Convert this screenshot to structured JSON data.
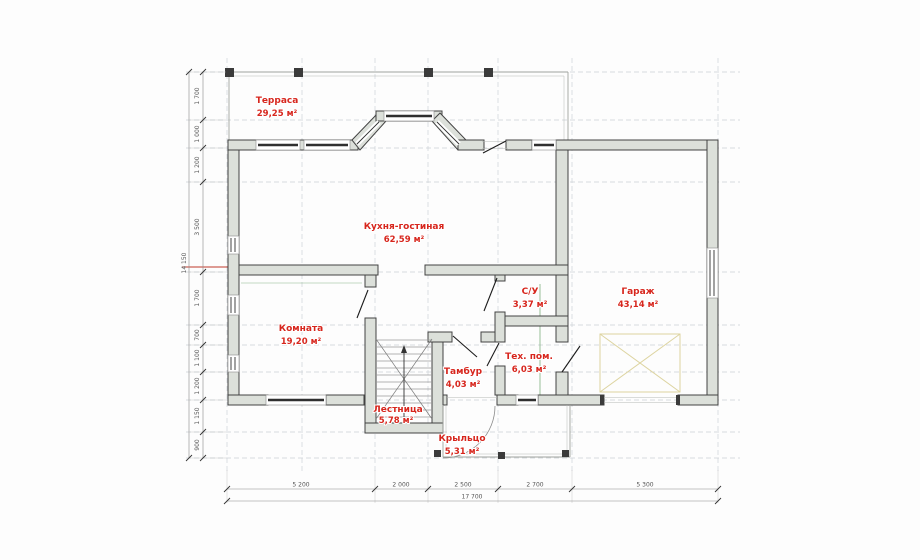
{
  "plan_type": "floor-plan",
  "rooms": [
    {
      "name": "Терраса",
      "area": "29,25 м²"
    },
    {
      "name": "Кухня-гостиная",
      "area": "62,59 м²"
    },
    {
      "name": "Комната",
      "area": "19,20 м²"
    },
    {
      "name": "С/У",
      "area": "3,37 м²"
    },
    {
      "name": "Гараж",
      "area": "43,14 м²"
    },
    {
      "name": "Тамбур",
      "area": "4,03 м²"
    },
    {
      "name": "Тех. пом.",
      "area": "6,03 м²"
    },
    {
      "name": "Лестница",
      "area": "5,78 м²"
    },
    {
      "name": "Крыльцо",
      "area": "5,31 м²"
    }
  ],
  "dimensions": {
    "left": {
      "segments": [
        "1 700",
        "1 000",
        "1 200",
        "3 500",
        "1 700",
        "700",
        "1 100",
        "1 200",
        "1 150",
        "900"
      ],
      "total": "14 150"
    },
    "bottom": {
      "segments": [
        "5 200",
        "2 000",
        "2 500",
        "2 700",
        "5 300"
      ],
      "total": "17 700"
    }
  },
  "colors": {
    "room_label": "#d7261d",
    "wall_fill": "#dce0da",
    "wall_stroke": "#424242",
    "dimension_text": "#555555",
    "grid_dash": "#ccd1d6",
    "accent_green": "#7fae7f",
    "accent_red": "#c0392b",
    "garage_marking": "#ddd4a0",
    "column_fill": "#3b3b3b"
  }
}
